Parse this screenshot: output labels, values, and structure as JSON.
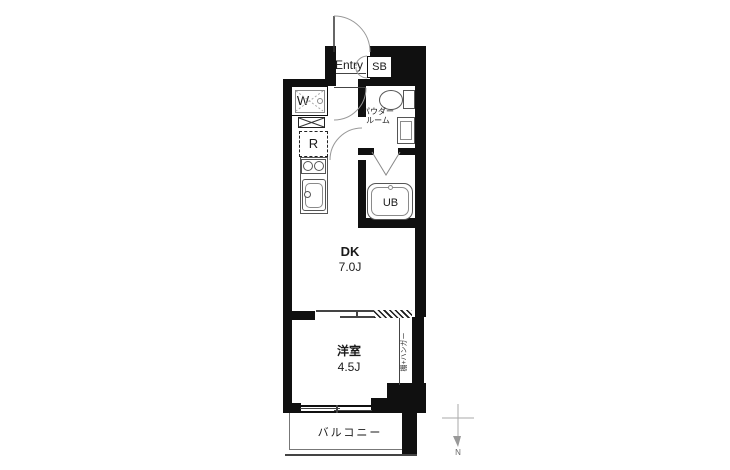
{
  "floorplan": {
    "background": "#ffffff",
    "wall_color": "#101010",
    "fixture_line_color": "#555555",
    "labels": {
      "entry": "Entry",
      "shoe_box": "SB",
      "washer": "W",
      "refrigerator": "R",
      "powder_room_line1": "パウダー",
      "powder_room_line2": "ルーム",
      "unit_bath": "UB",
      "dining_kitchen": "DK",
      "dining_kitchen_size": "7.0J",
      "western_room": "洋室",
      "western_room_size": "4.5J",
      "closet": "棚+ハンガー",
      "balcony": "バルコニー",
      "north": "N"
    }
  }
}
